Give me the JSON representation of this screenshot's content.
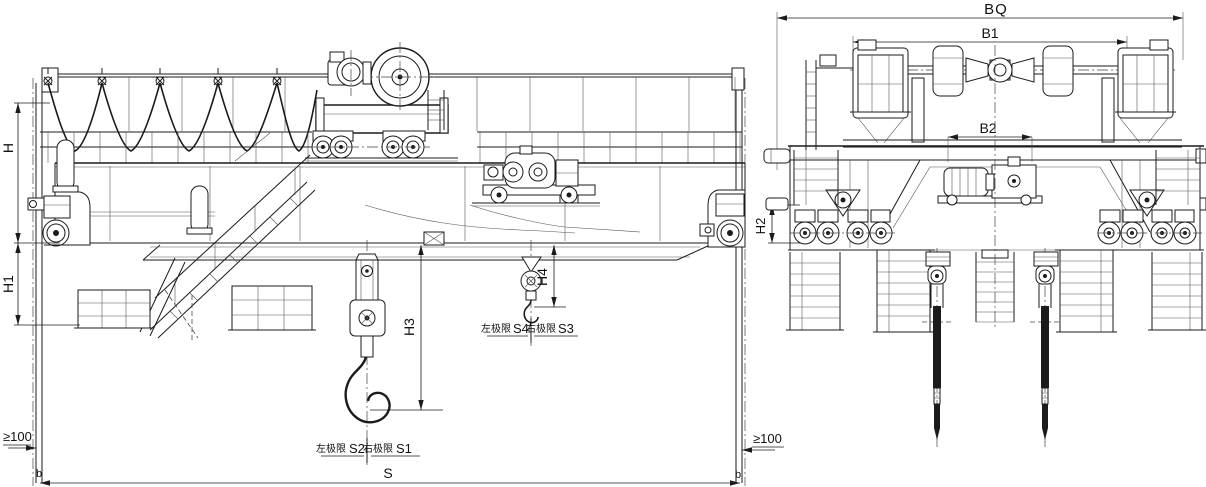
{
  "front_view": {
    "dims": {
      "h": "H",
      "h1": "H1",
      "h3": "H3",
      "h4": "H4",
      "span": "S",
      "clearance_left": "≥100",
      "clearance_right": "≥100",
      "rail_b_left": "b",
      "rail_b_right": "b"
    },
    "main_hook_limits": {
      "left_label": "左极限",
      "left_dim": "S2",
      "right_label": "右极限",
      "right_dim": "S1"
    },
    "aux_hook_limits": {
      "left_label": "左极限",
      "left_dim": "S4",
      "right_label": "右极限",
      "right_dim": "S3"
    }
  },
  "end_view": {
    "dims": {
      "bq": "BQ",
      "b1": "B1",
      "b2": "B2",
      "h2": "H2"
    }
  },
  "colors": {
    "ink": "#1b1b1b",
    "background": "#ffffff"
  }
}
